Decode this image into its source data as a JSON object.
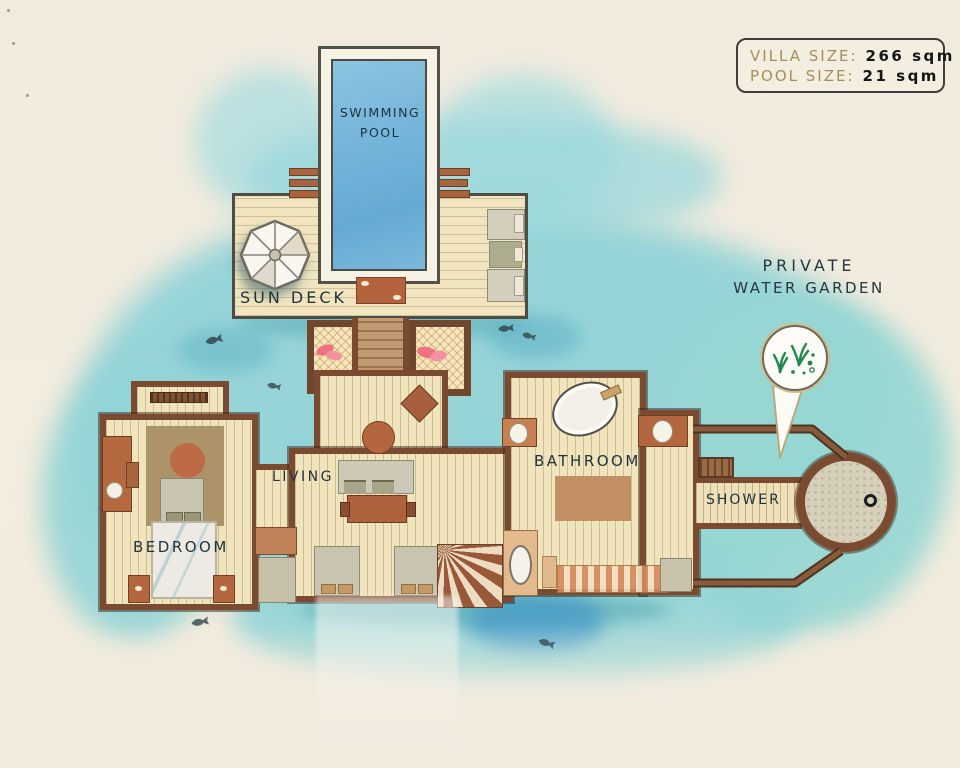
{
  "info_box": {
    "villa_label": "VILLA SIZE:",
    "villa_value": "266 sqm",
    "pool_label": "POOL SIZE:",
    "pool_value": "21 sqm"
  },
  "labels": {
    "swimming_pool_line1": "SWIMMING",
    "swimming_pool_line2": "POOL",
    "sun_deck": "SUN DECK",
    "private_water_garden_line1": "PRIVATE",
    "private_water_garden_line2": "WATER GARDEN",
    "bedroom": "BEDROOM",
    "living": "LIVING",
    "bathroom": "BATHROOM",
    "shower": "SHOWER"
  },
  "icons": {
    "umbrella": "umbrella-icon",
    "water_garden": "seaweed-icon",
    "fish": "fish-icon",
    "drain": "drain-icon"
  },
  "colors": {
    "paper": "#f2ecdf",
    "water": "#90d3d7",
    "water_deep": "#3f9fd0",
    "pool": "#74b4d9",
    "wall": "#7a4b31",
    "floor": "#f0e4bd",
    "terracotta": "#b4663f",
    "label_ink": "#22333c",
    "info_label": "#a39058",
    "info_value": "#161616",
    "seaweed": "#23884f"
  }
}
